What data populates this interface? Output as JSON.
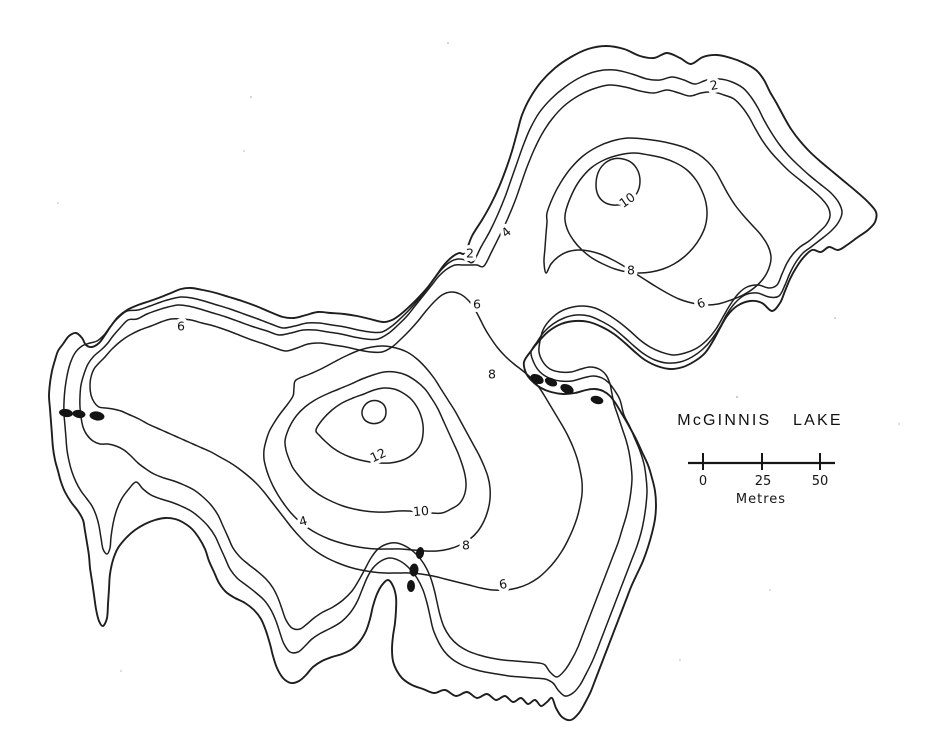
{
  "map": {
    "title": "McGINNIS LAKE",
    "scale_bar": {
      "ticks": [
        "0",
        "25",
        "50"
      ],
      "unit": "Metres"
    },
    "depth_contour_values": [
      2,
      4,
      6,
      8,
      10,
      12
    ],
    "contour_labels": [
      {
        "value": "2",
        "x": 714,
        "y": 85,
        "rot": -12
      },
      {
        "value": "2",
        "x": 470,
        "y": 253,
        "rot": 0
      },
      {
        "value": "4",
        "x": 506,
        "y": 232,
        "rot": -40
      },
      {
        "value": "6",
        "x": 477,
        "y": 304,
        "rot": 0
      },
      {
        "value": "10",
        "x": 627,
        "y": 200,
        "rot": -35
      },
      {
        "value": "8",
        "x": 631,
        "y": 270,
        "rot": 0
      },
      {
        "value": "6",
        "x": 701,
        "y": 303,
        "rot": -20
      },
      {
        "value": "6",
        "x": 181,
        "y": 326,
        "rot": 0
      },
      {
        "value": "8",
        "x": 492,
        "y": 374,
        "rot": 0
      },
      {
        "value": "12",
        "x": 378,
        "y": 455,
        "rot": -25
      },
      {
        "value": "10",
        "x": 421,
        "y": 511,
        "rot": -5
      },
      {
        "value": "4",
        "x": 303,
        "y": 521,
        "rot": -15
      },
      {
        "value": "8",
        "x": 466,
        "y": 545,
        "rot": 0
      },
      {
        "value": "6",
        "x": 503,
        "y": 584,
        "rot": -10
      }
    ],
    "sample_points": {
      "west_arm": [
        [
          66,
          413,
          7,
          4,
          8
        ],
        [
          79,
          414,
          6.5,
          4,
          8
        ],
        [
          97,
          416,
          7.5,
          4.5,
          8
        ]
      ],
      "north_channel": [
        [
          537,
          379,
          7,
          4.5,
          25
        ],
        [
          551,
          382,
          6.5,
          4,
          25
        ],
        [
          567,
          389,
          7,
          4.5,
          25
        ],
        [
          597,
          400,
          6.5,
          4,
          15
        ]
      ],
      "south_shore": [
        [
          420,
          553,
          4,
          6,
          10
        ],
        [
          414,
          570,
          4.5,
          6.5,
          5
        ],
        [
          411,
          586,
          4,
          6,
          0
        ]
      ]
    },
    "colors": {
      "ink": "#1e1e1e",
      "paper": "#ffffff"
    }
  }
}
